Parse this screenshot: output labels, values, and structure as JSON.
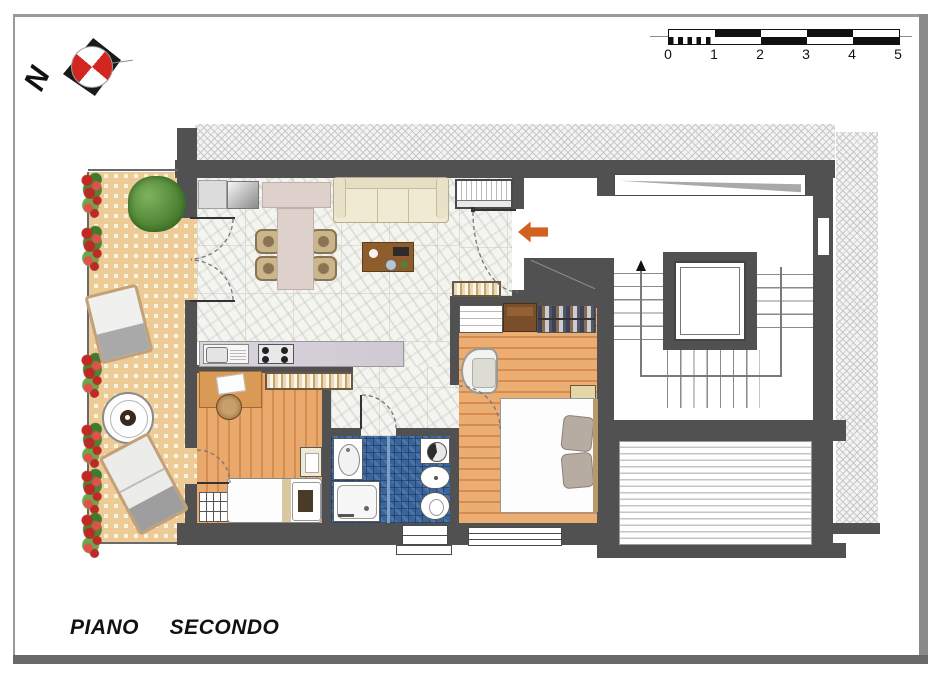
{
  "drawing": {
    "title": "PIANO  SECONDO",
    "north_label": "N",
    "scale_bar": {
      "unit_labels": [
        "0",
        "1",
        "2",
        "3",
        "4",
        "5"
      ]
    }
  },
  "palette": {
    "wall": "#515151",
    "wood_floor": "#e8a768",
    "terrace_tile": "#edcb97",
    "bathroom_tile": "#39659c",
    "sofa": "#f1ead2",
    "bed_duvet": "#645d8f",
    "entry_arrow": "#d2601e",
    "compass_red": "#d42620",
    "foliage_green": "#5f9340",
    "flower_red": "#c12924"
  },
  "icons": {
    "north_compass": "compass-icon",
    "entrance_arrow": "arrow-left-icon",
    "stair_direction": "arrow-up-icon"
  }
}
